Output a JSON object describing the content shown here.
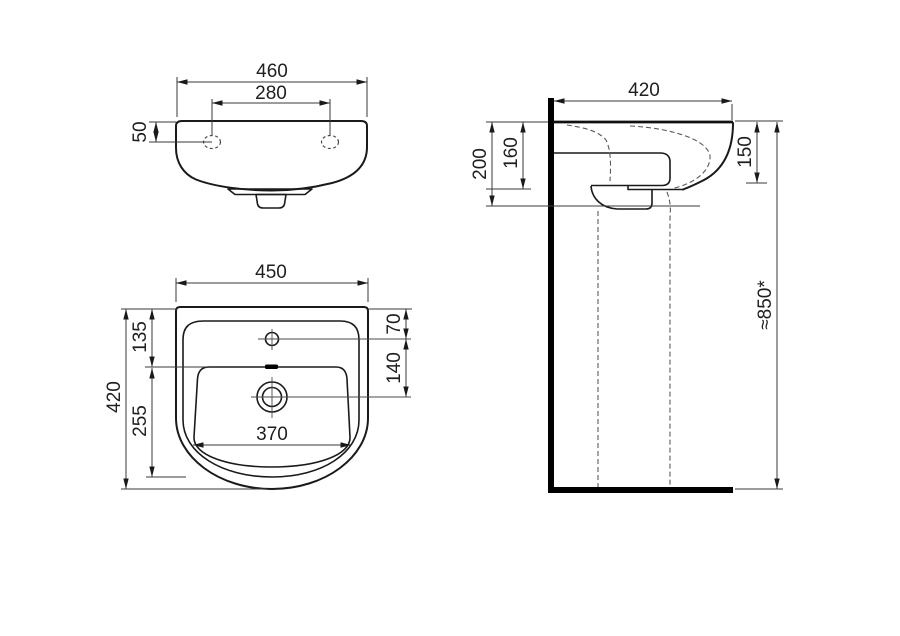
{
  "colors": {
    "background": "#ffffff",
    "outline": "#1a1a1a",
    "dimension_lines": "#3a3a3a",
    "hidden_lines": "#5a5a5a",
    "text": "#1f1f1f"
  },
  "dimensions": {
    "front": {
      "overall_width": "460",
      "hole_spacing": "280",
      "hole_top_offset": "50"
    },
    "plan": {
      "overall_width": "450",
      "overall_depth": "420",
      "tap_hole_from_back": "135",
      "bowl_front_extent": "255",
      "bowl_width": "370",
      "tap_hole_offset": "70",
      "tap_to_drain": "140"
    },
    "side": {
      "overall_depth": "420",
      "back_section_height": "200",
      "mid_section_height": "160",
      "front_edge_height": "150",
      "rim_height_from_floor": "≈850*"
    }
  }
}
